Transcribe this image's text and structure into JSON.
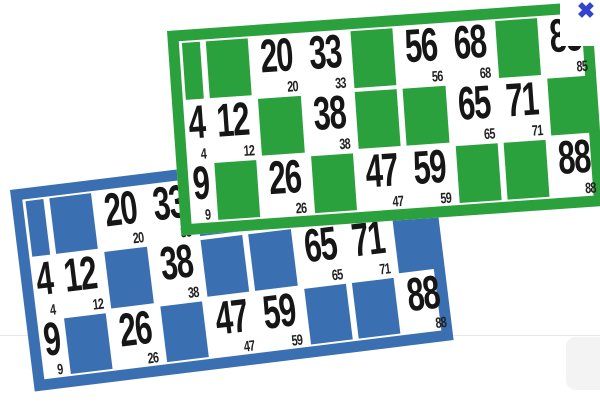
{
  "page": {
    "background_color": "#ffffff"
  },
  "close_button": {
    "glyph": "✖",
    "color": "#3344cc"
  },
  "cards": [
    {
      "id": "green",
      "color": "#2aa13c",
      "rows": [
        [
          null,
          null,
          20,
          33,
          null,
          56,
          68,
          null,
          85
        ],
        [
          4,
          12,
          null,
          38,
          null,
          null,
          65,
          71,
          null
        ],
        [
          9,
          null,
          26,
          null,
          47,
          59,
          null,
          null,
          88
        ]
      ]
    },
    {
      "id": "blue",
      "color": "#3a6fb2",
      "rows": [
        [
          null,
          null,
          20,
          33,
          null,
          56,
          68,
          null,
          85
        ],
        [
          4,
          12,
          null,
          38,
          null,
          null,
          65,
          71,
          null
        ],
        [
          9,
          null,
          26,
          null,
          47,
          59,
          null,
          null,
          88
        ]
      ]
    }
  ],
  "decor": {
    "divider_color": "#e8e8e8",
    "side_panel_color": "#f3f3f3",
    "number_color": "#161616"
  }
}
